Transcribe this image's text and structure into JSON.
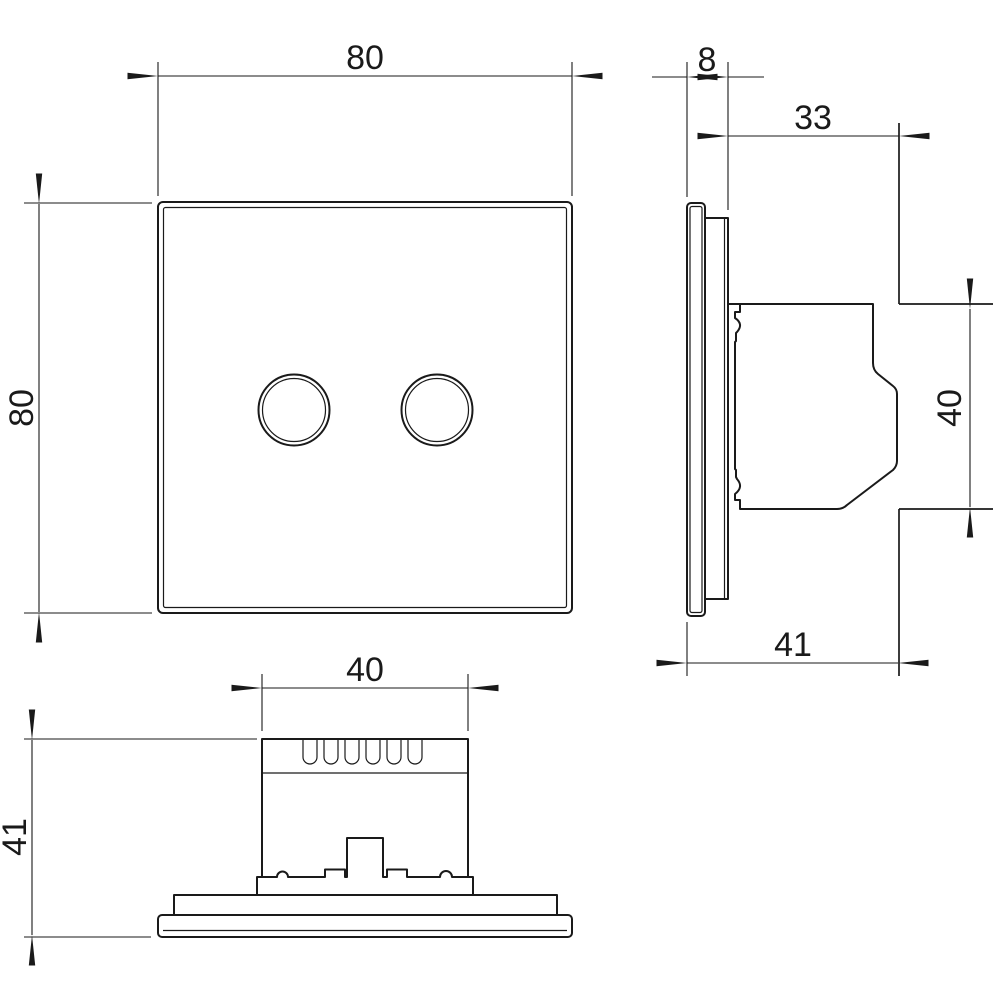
{
  "drawing": {
    "type": "technical-dimension-drawing",
    "background_color": "#ffffff",
    "line_color": "#1a1a1a",
    "dimensions": {
      "front_width": "80",
      "front_height": "80",
      "side_panel_thickness": "8",
      "side_box_depth": "33",
      "side_box_height": "40",
      "side_total_depth": "41",
      "bottom_box_width": "40",
      "bottom_total_height": "41"
    }
  }
}
